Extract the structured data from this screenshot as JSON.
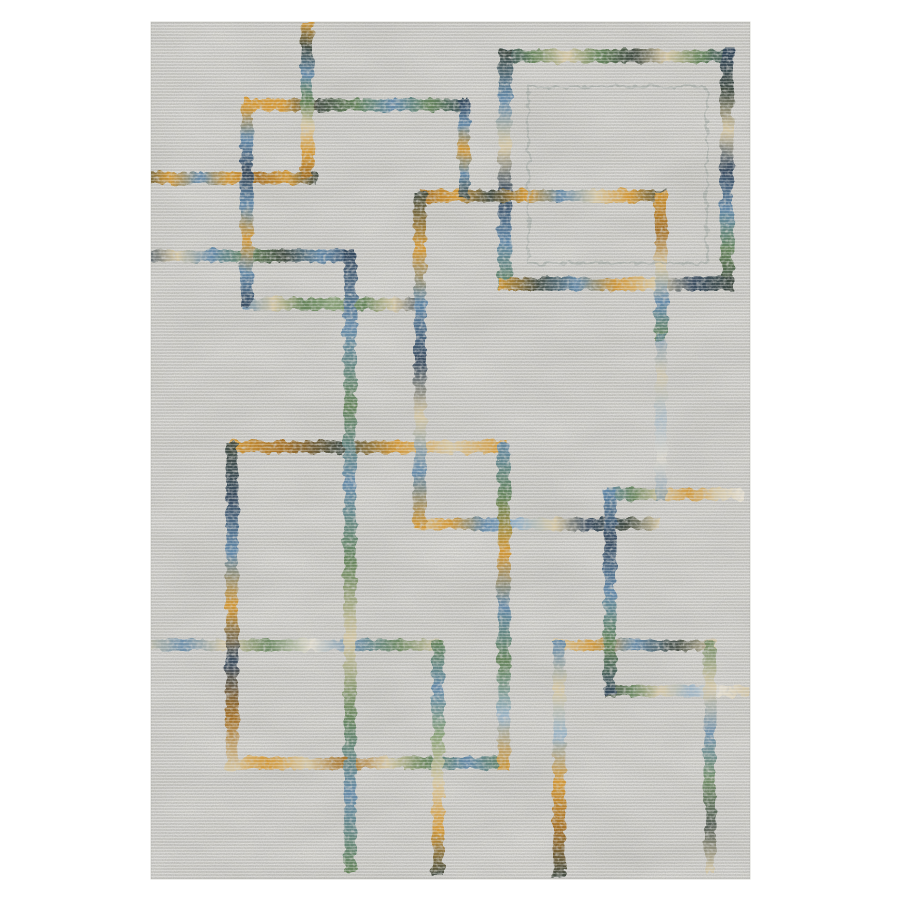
{
  "page": {
    "background": "#ffffff",
    "description": "Product photograph of a distressed modern geometric area rug on a white background"
  },
  "rug": {
    "bounds": {
      "x": 151,
      "y": 22,
      "width": 599,
      "height": 857
    },
    "base_color": "#edece8",
    "edge_color": "#d8d8d3",
    "palette": {
      "gold": "#d4962f",
      "goldDark": "#a26c1f",
      "blue": "#5f87a8",
      "lightBlue": "#97b2c6",
      "navy": "#31455a",
      "dark": "#3b463c",
      "green": "#5f8054",
      "greenLight": "#87a075",
      "tan": "#d6c7a3",
      "cream": "#e6e0d2"
    },
    "segments": [
      {
        "id": "bigsq-top",
        "o": "h",
        "pos": 56,
        "a": 499,
        "b": 734,
        "w": 13,
        "stops": [
          "navy",
          "green",
          "tan",
          "green",
          "dark",
          "tan",
          "green",
          "navy"
        ]
      },
      {
        "id": "bigsq-left",
        "o": "v",
        "pos": 505,
        "a": 50,
        "b": 290,
        "w": 13,
        "stops": [
          "dark",
          "blue",
          "tan",
          "navy",
          "blue",
          "green"
        ]
      },
      {
        "id": "bigsq-right",
        "o": "v",
        "pos": 727,
        "a": 50,
        "b": 290,
        "w": 13,
        "stops": [
          "navy",
          "dark",
          "tan",
          "navy",
          "blue",
          "green",
          "dark"
        ]
      },
      {
        "id": "bigsq-bottom",
        "o": "h",
        "pos": 284,
        "a": 499,
        "b": 734,
        "w": 13,
        "stops": [
          "gold",
          "dark",
          "blue",
          "gold",
          "tan",
          "navy",
          "dark"
        ]
      },
      {
        "id": "h-top-gold-green",
        "o": "h",
        "pos": 105,
        "a": 243,
        "b": 468,
        "w": 12,
        "stops": [
          "gold",
          "gold",
          "dark",
          "green",
          "blue",
          "green",
          "navy"
        ]
      },
      {
        "id": "h-left-gold",
        "o": "h",
        "pos": 178,
        "a": 140,
        "b": 317,
        "w": 12,
        "stops": [
          "dark",
          "gold",
          "blue",
          "gold",
          "goldDark",
          "gold",
          "dark"
        ]
      },
      {
        "id": "h-mid-gold",
        "o": "h",
        "pos": 196,
        "a": 420,
        "b": 666,
        "w": 12,
        "stops": [
          "goldDark",
          "gold",
          "dark",
          "gold",
          "blue",
          "tan",
          "gold",
          "dark"
        ]
      },
      {
        "id": "h-left-dark",
        "o": "h",
        "pos": 256,
        "a": 140,
        "b": 356,
        "w": 12,
        "stops": [
          "navy",
          "tan",
          "blue",
          "green",
          "dark",
          "blue",
          "navy"
        ]
      },
      {
        "id": "h-left-green",
        "o": "h",
        "pos": 304,
        "a": 243,
        "b": 424,
        "w": 12,
        "stops": [
          "blue",
          "tan",
          "green",
          "greenLight",
          "green",
          "tan",
          "navy"
        ]
      },
      {
        "id": "h-center-gold",
        "o": "h",
        "pos": 447,
        "a": 230,
        "b": 506,
        "w": 12,
        "stops": [
          "gold",
          "goldDark",
          "dark",
          "gold",
          "tan",
          "gold"
        ]
      },
      {
        "id": "h-right-mixed",
        "o": "h",
        "pos": 494,
        "a": 606,
        "b": 743,
        "w": 12,
        "op": 0.9,
        "stops": [
          "blue",
          "green",
          "tan",
          "gold",
          "tan",
          "cream"
        ]
      },
      {
        "id": "h-center-mixed",
        "o": "h",
        "pos": 524,
        "a": 414,
        "b": 660,
        "w": 12,
        "stops": [
          "tan",
          "gold",
          "blue",
          "lightBlue",
          "tan",
          "navy",
          "dark",
          "tan"
        ]
      },
      {
        "id": "h-lower-long",
        "o": "h",
        "pos": 645,
        "a": 140,
        "b": 440,
        "w": 11,
        "op": 0.85,
        "stops": [
          "tan",
          "blue",
          "tan",
          "green",
          "cream",
          "blue",
          "green",
          "tan"
        ]
      },
      {
        "id": "h-lower-right",
        "o": "h",
        "pos": 645,
        "a": 553,
        "b": 716,
        "w": 11,
        "op": 0.9,
        "stops": [
          "tan",
          "gold",
          "blue",
          "dark",
          "tan"
        ]
      },
      {
        "id": "h-lowright-green",
        "o": "h",
        "pos": 691,
        "a": 604,
        "b": 748,
        "w": 11,
        "op": 0.85,
        "stops": [
          "dark",
          "green",
          "tan",
          "lightBlue",
          "cream",
          "tan"
        ]
      },
      {
        "id": "h-bottom-tan",
        "o": "h",
        "pos": 763,
        "a": 226,
        "b": 508,
        "w": 12,
        "stops": [
          "tan",
          "gold",
          "tan",
          "goldDark",
          "tan",
          "green",
          "blue",
          "green"
        ]
      },
      {
        "id": "v-top-stem",
        "o": "v",
        "pos": 307,
        "a": 22,
        "b": 178,
        "w": 12,
        "stops": [
          "gold",
          "dark",
          "blue",
          "green",
          "tan",
          "gold",
          "goldDark"
        ]
      },
      {
        "id": "v-left-blue",
        "o": "v",
        "pos": 247,
        "a": 105,
        "b": 306,
        "w": 12,
        "stops": [
          "gold",
          "blue",
          "navy",
          "blue",
          "gold",
          "blue",
          "navy"
        ]
      },
      {
        "id": "v-mid-short",
        "o": "v",
        "pos": 464,
        "a": 100,
        "b": 198,
        "w": 12,
        "stops": [
          "navy",
          "blue",
          "gold",
          "blue",
          "dark"
        ]
      },
      {
        "id": "v-mid-left",
        "o": "v",
        "pos": 420,
        "a": 192,
        "b": 528,
        "w": 12,
        "stops": [
          "dark",
          "gold",
          "blue",
          "navy",
          "tan",
          "blue",
          "gold"
        ]
      },
      {
        "id": "v-mid-right",
        "o": "v",
        "pos": 661,
        "a": 192,
        "b": 340,
        "w": 12,
        "stops": [
          "gold",
          "goldDark",
          "tan",
          "blue",
          "green"
        ]
      },
      {
        "id": "v-mid-right-fade",
        "o": "v",
        "pos": 661,
        "a": 335,
        "b": 500,
        "w": 11,
        "op": 0.55,
        "stops": [
          "blue",
          "tan",
          "lightBlue",
          "cream",
          "blue"
        ]
      },
      {
        "id": "v-long-green",
        "o": "v",
        "pos": 350,
        "a": 250,
        "b": 872,
        "w": 12,
        "op": 0.92,
        "stops": [
          "navy",
          "blue",
          "green",
          "blue",
          "green",
          "tan",
          "green",
          "blue",
          "green"
        ]
      },
      {
        "id": "v-lowleft",
        "o": "v",
        "pos": 232,
        "a": 443,
        "b": 770,
        "w": 12,
        "stops": [
          "dark",
          "navy",
          "blue",
          "gold",
          "navy",
          "goldDark",
          "tan"
        ]
      },
      {
        "id": "v-lowmid",
        "o": "v",
        "pos": 504,
        "a": 443,
        "b": 770,
        "w": 12,
        "stops": [
          "blue",
          "green",
          "gold",
          "blue",
          "green",
          "lightBlue",
          "gold"
        ]
      },
      {
        "id": "v-lowright",
        "o": "v",
        "pos": 610,
        "a": 490,
        "b": 695,
        "w": 12,
        "stops": [
          "blue",
          "navy",
          "blue",
          "green",
          "navy"
        ]
      },
      {
        "id": "v-bottom-1",
        "o": "v",
        "pos": 438,
        "a": 641,
        "b": 877,
        "w": 12,
        "stops": [
          "green",
          "blue",
          "greenLight",
          "tan",
          "gold",
          "dark"
        ]
      },
      {
        "id": "v-bottom-2",
        "o": "v",
        "pos": 559,
        "a": 641,
        "b": 877,
        "w": 12,
        "stops": [
          "blue",
          "tan",
          "lightBlue",
          "gold",
          "goldDark",
          "dark"
        ]
      },
      {
        "id": "v-bottom-3",
        "o": "v",
        "pos": 710,
        "a": 641,
        "b": 872,
        "w": 11,
        "op": 0.8,
        "stops": [
          "green",
          "tan",
          "blue",
          "green",
          "dark",
          "tan"
        ]
      }
    ],
    "inner_rect": {
      "x": 528,
      "y": 87,
      "x2": 707,
      "y2": 263,
      "stroke": "#98a09a",
      "width": 2,
      "opacity": 0.55
    }
  },
  "texture": {
    "grain_color": "#83837e",
    "mottle_color": "#6f6f6a",
    "rib_light": "rgba(255,255,255,0.5)",
    "rib_dark": "rgba(110,110,105,0.16)"
  }
}
